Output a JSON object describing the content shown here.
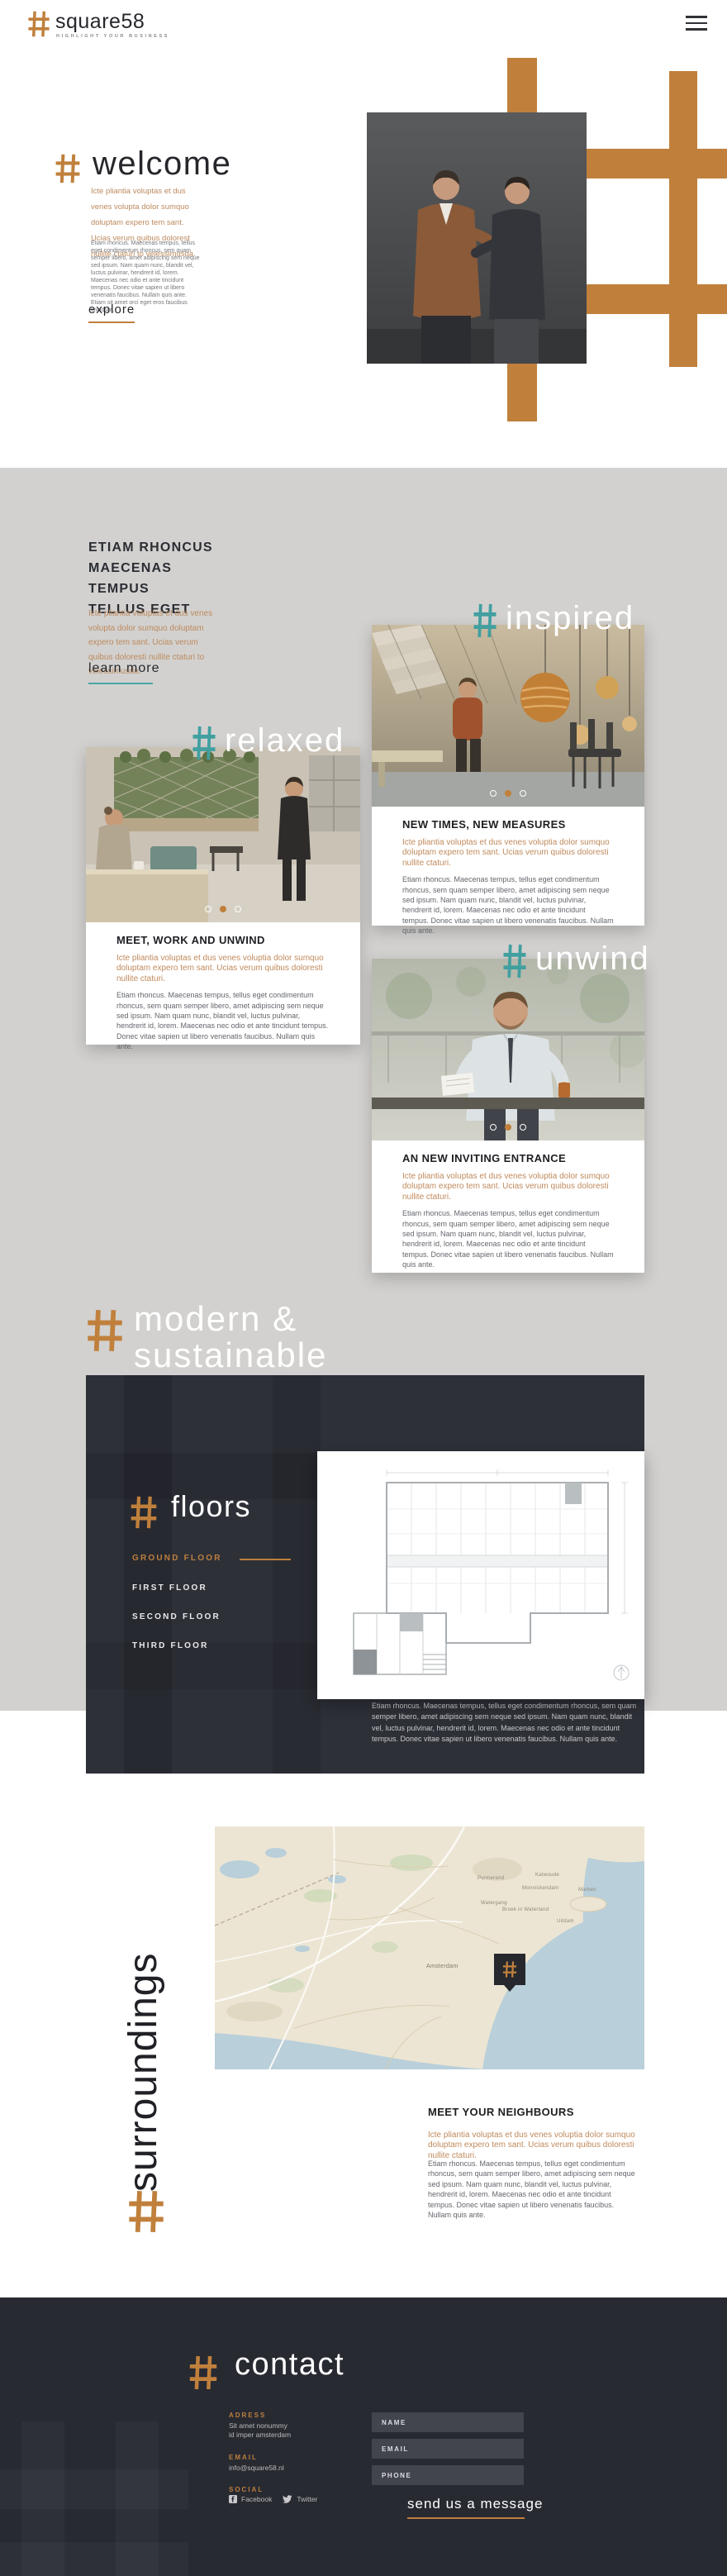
{
  "brand": {
    "name": "square58",
    "tagline": "HIGHLIGHT YOUR BUSINESS"
  },
  "colors": {
    "accent": "#c0803c",
    "teal": "#419fa0",
    "dark_bg": "#2e3038",
    "footer_bg": "#282a32",
    "gray_bg": "#d2d1cf",
    "orange_text": "#c08a5c"
  },
  "welcome": {
    "title": "welcome",
    "intro": "Icte pliantia voluptas et dus venes volupta dolor sumquo doluptam expero tem sant. Ucias verum quibus dolorest nullite ctaturi to velessimusda.",
    "body": "Etiam rhoncus. Maecenas tempus, tellus eget condimentum rhoncus, sem quam semper libero, amet adipiscing sem neque sed ipsum. Nam quam nunc, blandit vel, luctus pulvinar, hendrerit id, lorem. Maecenas nec odio et ante tincidunt tempus. Donec vitae sapien ut libero venenatis faucibus. Nullam quis ante. Etiam sit amet orci eget eros faucibus tincidunt.",
    "cta": "explore"
  },
  "intro_block": {
    "title_lines": [
      "ETIAM RHONCUS",
      "MAECENAS TEMPUS",
      "TELLUS EGET"
    ],
    "intro": "Icte pliantia voluptas et dus venes volupta dolor sumquo doluptam expero tem sant. Ucias verum quibus doloresti nullite ctaturi to velessimusda.",
    "cta": "learn more"
  },
  "overlay_words": {
    "inspired": "inspired",
    "relaxed": "relaxed",
    "unwind": "unwind",
    "modern_line1": "modern &",
    "modern_line2": "sustainable",
    "surroundings": "surroundings"
  },
  "cards": [
    {
      "title": "NEW TIMES, NEW MEASURES",
      "intro": "Icte pliantia voluptas et dus venes voluptia dolor sumquo doluptam expero tem sant. Ucias verum quibus doloresti nullite ctaturi.",
      "body": "Etiam rhoncus. Maecenas tempus, tellus eget condimentum rhoncus, sem quam semper libero, amet adipiscing sem neque sed ipsum. Nam quam nunc, blandit vel, luctus pulvinar, hendrerit id, lorem. Maecenas nec odio et ante tincidunt tempus. Donec vitae sapien ut libero venenatis faucibus. Nullam quis ante."
    },
    {
      "title": "MEET, WORK AND UNWIND",
      "intro": "Icte pliantia voluptas et dus venes voluptia dolor sumquo doluptam expero tem sant. Ucias verum quibus doloresti nullite ctaturi.",
      "body": "Etiam rhoncus. Maecenas tempus, tellus eget condimentum rhoncus, sem quam semper libero, amet adipiscing sem neque sed ipsum. Nam quam nunc, blandit vel, luctus pulvinar, hendrerit id, lorem. Maecenas nec odio et ante tincidunt tempus. Donec vitae sapien ut libero venenatis faucibus. Nullam quis ante."
    },
    {
      "title": "AN NEW INVITING ENTRANCE",
      "intro": "Icte pliantia voluptas et dus venes voluptia dolor sumquo doluptam expero tem sant. Ucias verum quibus doloresti nullite ctaturi.",
      "body": "Etiam rhoncus. Maecenas tempus, tellus eget condimentum rhoncus, sem quam semper libero, amet adipiscing sem neque sed ipsum. Nam quam nunc, blandit vel, luctus pulvinar, hendrerit id, lorem. Maecenas nec odio et ante tincidunt tempus. Donec vitae sapien ut libero venenatis faucibus. Nullam quis ante."
    }
  ],
  "floors": {
    "title": "floors",
    "menu": [
      "GROUND FLOOR",
      "FIRST FLOOR",
      "SECOND FLOOR",
      "THIRD FLOOR"
    ],
    "active_index": 0,
    "body": "Etiam rhoncus. Maecenas tempus, tellus eget condimentum rhoncus, sem quam semper libero, amet adipiscing sem neque sed ipsum. Nam quam nunc, blandit vel, luctus pulvinar, hendrerit id, lorem. Maecenas nec odio et ante tincidunt tempus. Donec vitae sapien ut libero venenatis faucibus. Nullam quis ante."
  },
  "surroundings": {
    "card": {
      "title": "MEET YOUR NEIGHBOURS",
      "intro": "Icte pliantia voluptas et dus venes voluptia dolor sumquo doluptam expero tem sant. Ucias verum quibus doloresti nullite ctaturi.",
      "body": "Etiam rhoncus. Maecenas tempus, tellus eget condimentum rhoncus, sem quam semper libero, amet adipiscing sem neque sed ipsum. Nam quam nunc, blandit vel, luctus pulvinar, hendrerit id, lorem. Maecenas nec odio et ante tincidunt tempus. Donec vitae sapien ut libero venenatis faucibus. Nullam quis ante."
    },
    "map_labels": [
      "Purmerend",
      "Katwoude",
      "Monnickendam",
      "Marken",
      "Watergang",
      "Broek in Waterland",
      "Uitdam",
      "Amsterdam"
    ]
  },
  "contact": {
    "title": "contact",
    "address_label": "ADRESS",
    "address_line1": "Sit amet nonummy",
    "address_line2": "id imper amsterdam",
    "email_label": "EMAIL",
    "email_value": "info@square58.nl",
    "social_label": "SOCIAL",
    "facebook": "Facebook",
    "twitter": "Twitter",
    "form": {
      "name_placeholder": "NAME",
      "email_placeholder": "EMAIL",
      "phone_placeholder": "PHONE",
      "submit": "send us a message"
    }
  }
}
